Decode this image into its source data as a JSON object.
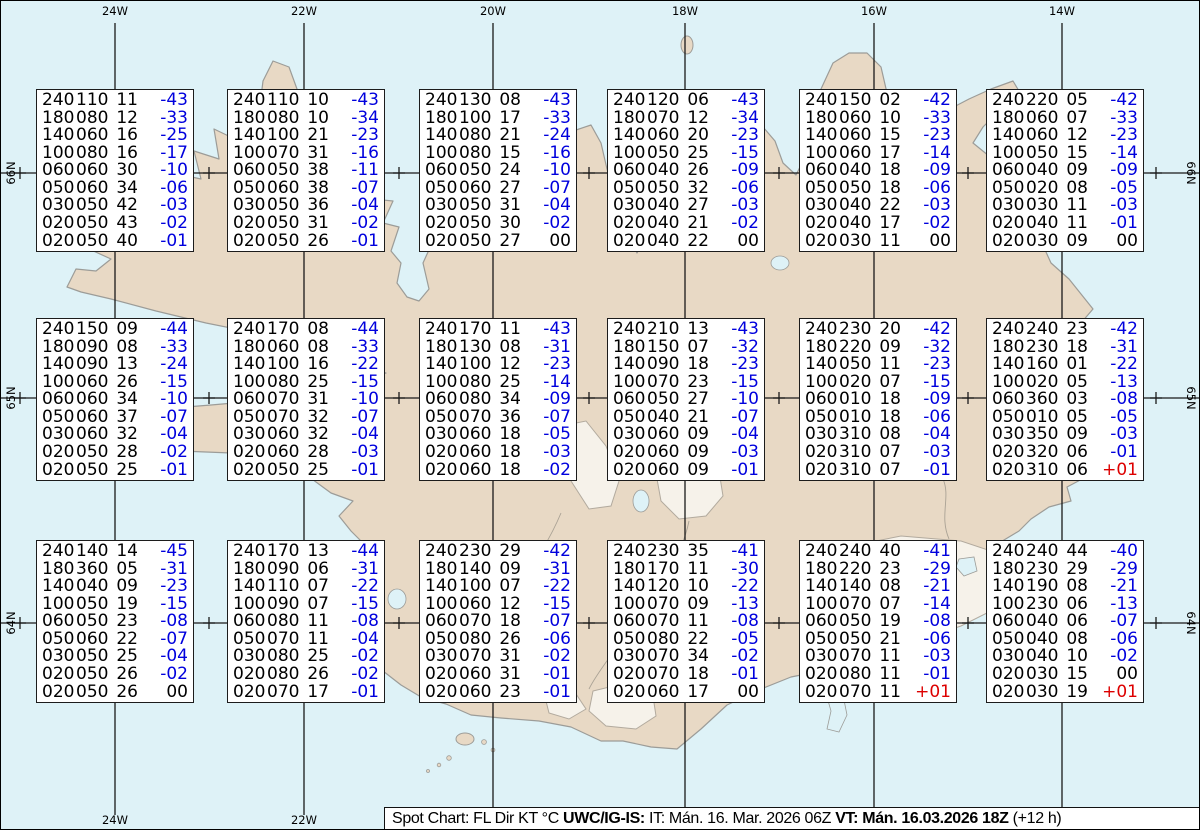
{
  "map": {
    "longitude_labels": [
      "24W",
      "22W",
      "20W",
      "18W",
      "16W",
      "14W"
    ],
    "latitude_labels": [
      "66N",
      "65N",
      "64N"
    ],
    "colors": {
      "water": "#def2f7",
      "land": "#e8d9c5",
      "glacier": "#f6f2ea",
      "coastline": "#9c9c98",
      "grid": "#1a1a1a",
      "temp_negative": "#0000dd",
      "temp_positive": "#dd0000",
      "temp_zero": "#000000"
    }
  },
  "spot_boxes": [
    {
      "lines": [
        [
          "240",
          "110",
          "11",
          "-43"
        ],
        [
          "180",
          "080",
          "12",
          "-33"
        ],
        [
          "140",
          "060",
          "16",
          "-25"
        ],
        [
          "100",
          "080",
          "16",
          "-17"
        ],
        [
          "060",
          "060",
          "30",
          "-10"
        ],
        [
          "050",
          "060",
          "34",
          "-06"
        ],
        [
          "030",
          "050",
          "42",
          "-03"
        ],
        [
          "020",
          "050",
          "43",
          "-02"
        ],
        [
          "020",
          "050",
          "40",
          "-01"
        ]
      ]
    },
    {
      "lines": [
        [
          "240",
          "110",
          "10",
          "-43"
        ],
        [
          "180",
          "080",
          "10",
          "-34"
        ],
        [
          "140",
          "100",
          "21",
          "-23"
        ],
        [
          "100",
          "070",
          "31",
          "-16"
        ],
        [
          "060",
          "050",
          "38",
          "-11"
        ],
        [
          "050",
          "060",
          "38",
          "-07"
        ],
        [
          "030",
          "050",
          "36",
          "-04"
        ],
        [
          "020",
          "050",
          "31",
          "-02"
        ],
        [
          "020",
          "050",
          "26",
          "-01"
        ]
      ]
    },
    {
      "lines": [
        [
          "240",
          "130",
          "08",
          "-43"
        ],
        [
          "180",
          "100",
          "17",
          "-33"
        ],
        [
          "140",
          "080",
          "21",
          "-24"
        ],
        [
          "100",
          "080",
          "15",
          "-16"
        ],
        [
          "060",
          "050",
          "24",
          "-10"
        ],
        [
          "050",
          "060",
          "27",
          "-07"
        ],
        [
          "030",
          "050",
          "31",
          "-04"
        ],
        [
          "020",
          "050",
          "30",
          "-02"
        ],
        [
          "020",
          "050",
          "27",
          "00"
        ]
      ]
    },
    {
      "lines": [
        [
          "240",
          "120",
          "06",
          "-43"
        ],
        [
          "180",
          "070",
          "12",
          "-34"
        ],
        [
          "140",
          "060",
          "20",
          "-23"
        ],
        [
          "100",
          "050",
          "25",
          "-15"
        ],
        [
          "060",
          "040",
          "26",
          "-09"
        ],
        [
          "050",
          "050",
          "32",
          "-06"
        ],
        [
          "030",
          "040",
          "27",
          "-03"
        ],
        [
          "020",
          "040",
          "21",
          "-02"
        ],
        [
          "020",
          "040",
          "22",
          "00"
        ]
      ]
    },
    {
      "lines": [
        [
          "240",
          "150",
          "02",
          "-42"
        ],
        [
          "180",
          "060",
          "10",
          "-33"
        ],
        [
          "140",
          "060",
          "15",
          "-23"
        ],
        [
          "100",
          "060",
          "17",
          "-14"
        ],
        [
          "060",
          "040",
          "18",
          "-09"
        ],
        [
          "050",
          "050",
          "18",
          "-06"
        ],
        [
          "030",
          "040",
          "22",
          "-03"
        ],
        [
          "020",
          "040",
          "17",
          "-02"
        ],
        [
          "020",
          "030",
          "11",
          "00"
        ]
      ]
    },
    {
      "lines": [
        [
          "240",
          "220",
          "05",
          "-42"
        ],
        [
          "180",
          "060",
          "07",
          "-33"
        ],
        [
          "140",
          "060",
          "12",
          "-23"
        ],
        [
          "100",
          "050",
          "15",
          "-14"
        ],
        [
          "060",
          "040",
          "09",
          "-09"
        ],
        [
          "050",
          "020",
          "08",
          "-05"
        ],
        [
          "030",
          "030",
          "11",
          "-03"
        ],
        [
          "020",
          "040",
          "11",
          "-01"
        ],
        [
          "020",
          "030",
          "09",
          "00"
        ]
      ]
    },
    {
      "lines": [
        [
          "240",
          "150",
          "09",
          "-44"
        ],
        [
          "180",
          "090",
          "08",
          "-33"
        ],
        [
          "140",
          "090",
          "13",
          "-24"
        ],
        [
          "100",
          "060",
          "26",
          "-15"
        ],
        [
          "060",
          "060",
          "34",
          "-10"
        ],
        [
          "050",
          "060",
          "37",
          "-07"
        ],
        [
          "030",
          "060",
          "32",
          "-04"
        ],
        [
          "020",
          "050",
          "28",
          "-02"
        ],
        [
          "020",
          "050",
          "25",
          "-01"
        ]
      ]
    },
    {
      "lines": [
        [
          "240",
          "170",
          "08",
          "-44"
        ],
        [
          "180",
          "060",
          "08",
          "-33"
        ],
        [
          "140",
          "100",
          "16",
          "-22"
        ],
        [
          "100",
          "080",
          "25",
          "-15"
        ],
        [
          "060",
          "070",
          "31",
          "-10"
        ],
        [
          "050",
          "070",
          "32",
          "-07"
        ],
        [
          "030",
          "060",
          "32",
          "-04"
        ],
        [
          "020",
          "060",
          "28",
          "-03"
        ],
        [
          "020",
          "050",
          "25",
          "-01"
        ]
      ]
    },
    {
      "lines": [
        [
          "240",
          "170",
          "11",
          "-43"
        ],
        [
          "180",
          "130",
          "08",
          "-31"
        ],
        [
          "140",
          "100",
          "12",
          "-23"
        ],
        [
          "100",
          "080",
          "25",
          "-14"
        ],
        [
          "060",
          "080",
          "34",
          "-09"
        ],
        [
          "050",
          "070",
          "36",
          "-07"
        ],
        [
          "030",
          "060",
          "18",
          "-05"
        ],
        [
          "020",
          "060",
          "18",
          "-03"
        ],
        [
          "020",
          "060",
          "18",
          "-02"
        ]
      ]
    },
    {
      "lines": [
        [
          "240",
          "210",
          "13",
          "-43"
        ],
        [
          "180",
          "150",
          "07",
          "-32"
        ],
        [
          "140",
          "090",
          "18",
          "-23"
        ],
        [
          "100",
          "070",
          "23",
          "-15"
        ],
        [
          "060",
          "050",
          "27",
          "-10"
        ],
        [
          "050",
          "040",
          "21",
          "-07"
        ],
        [
          "030",
          "060",
          "09",
          "-04"
        ],
        [
          "020",
          "060",
          "09",
          "-03"
        ],
        [
          "020",
          "060",
          "09",
          "-01"
        ]
      ]
    },
    {
      "lines": [
        [
          "240",
          "230",
          "20",
          "-42"
        ],
        [
          "180",
          "220",
          "09",
          "-32"
        ],
        [
          "140",
          "050",
          "11",
          "-23"
        ],
        [
          "100",
          "020",
          "07",
          "-15"
        ],
        [
          "060",
          "010",
          "18",
          "-09"
        ],
        [
          "050",
          "010",
          "18",
          "-06"
        ],
        [
          "030",
          "310",
          "08",
          "-04"
        ],
        [
          "020",
          "310",
          "07",
          "-03"
        ],
        [
          "020",
          "310",
          "07",
          "-01"
        ]
      ]
    },
    {
      "lines": [
        [
          "240",
          "240",
          "23",
          "-42"
        ],
        [
          "180",
          "230",
          "18",
          "-31"
        ],
        [
          "140",
          "160",
          "01",
          "-22"
        ],
        [
          "100",
          "020",
          "05",
          "-13"
        ],
        [
          "060",
          "360",
          "03",
          "-08"
        ],
        [
          "050",
          "010",
          "05",
          "-05"
        ],
        [
          "030",
          "350",
          "09",
          "-03"
        ],
        [
          "020",
          "320",
          "06",
          "-01"
        ],
        [
          "020",
          "310",
          "06",
          "+01"
        ]
      ]
    },
    {
      "lines": [
        [
          "240",
          "140",
          "14",
          "-45"
        ],
        [
          "180",
          "360",
          "05",
          "-31"
        ],
        [
          "140",
          "040",
          "09",
          "-23"
        ],
        [
          "100",
          "050",
          "19",
          "-15"
        ],
        [
          "060",
          "050",
          "23",
          "-08"
        ],
        [
          "050",
          "060",
          "22",
          "-07"
        ],
        [
          "030",
          "050",
          "25",
          "-04"
        ],
        [
          "020",
          "050",
          "26",
          "-02"
        ],
        [
          "020",
          "050",
          "26",
          "00"
        ]
      ]
    },
    {
      "lines": [
        [
          "240",
          "170",
          "13",
          "-44"
        ],
        [
          "180",
          "090",
          "06",
          "-31"
        ],
        [
          "140",
          "110",
          "07",
          "-22"
        ],
        [
          "100",
          "090",
          "07",
          "-15"
        ],
        [
          "060",
          "080",
          "11",
          "-08"
        ],
        [
          "050",
          "070",
          "11",
          "-04"
        ],
        [
          "030",
          "080",
          "25",
          "-02"
        ],
        [
          "020",
          "080",
          "26",
          "-02"
        ],
        [
          "020",
          "070",
          "17",
          "-01"
        ]
      ]
    },
    {
      "lines": [
        [
          "240",
          "230",
          "29",
          "-42"
        ],
        [
          "180",
          "140",
          "09",
          "-31"
        ],
        [
          "140",
          "100",
          "07",
          "-22"
        ],
        [
          "100",
          "060",
          "12",
          "-15"
        ],
        [
          "060",
          "070",
          "18",
          "-07"
        ],
        [
          "050",
          "080",
          "26",
          "-06"
        ],
        [
          "030",
          "070",
          "31",
          "-02"
        ],
        [
          "020",
          "060",
          "31",
          "-01"
        ],
        [
          "020",
          "060",
          "23",
          "-01"
        ]
      ]
    },
    {
      "lines": [
        [
          "240",
          "230",
          "35",
          "-41"
        ],
        [
          "180",
          "170",
          "11",
          "-30"
        ],
        [
          "140",
          "120",
          "10",
          "-22"
        ],
        [
          "100",
          "070",
          "09",
          "-13"
        ],
        [
          "060",
          "070",
          "11",
          "-08"
        ],
        [
          "050",
          "080",
          "22",
          "-05"
        ],
        [
          "030",
          "070",
          "34",
          "-02"
        ],
        [
          "020",
          "070",
          "18",
          "-01"
        ],
        [
          "020",
          "060",
          "17",
          "00"
        ]
      ]
    },
    {
      "lines": [
        [
          "240",
          "240",
          "40",
          "-41"
        ],
        [
          "180",
          "220",
          "23",
          "-29"
        ],
        [
          "140",
          "140",
          "08",
          "-21"
        ],
        [
          "100",
          "070",
          "07",
          "-14"
        ],
        [
          "060",
          "050",
          "19",
          "-08"
        ],
        [
          "050",
          "050",
          "21",
          "-06"
        ],
        [
          "030",
          "070",
          "11",
          "-03"
        ],
        [
          "020",
          "080",
          "11",
          "-01"
        ],
        [
          "020",
          "070",
          "11",
          "+01"
        ]
      ]
    },
    {
      "lines": [
        [
          "240",
          "240",
          "44",
          "-40"
        ],
        [
          "180",
          "230",
          "29",
          "-29"
        ],
        [
          "140",
          "190",
          "08",
          "-21"
        ],
        [
          "100",
          "230",
          "06",
          "-13"
        ],
        [
          "060",
          "040",
          "06",
          "-07"
        ],
        [
          "050",
          "040",
          "08",
          "-06"
        ],
        [
          "030",
          "040",
          "10",
          "-02"
        ],
        [
          "020",
          "030",
          "15",
          "00"
        ],
        [
          "020",
          "030",
          "19",
          "+01"
        ]
      ]
    }
  ],
  "footer_segments": [
    {
      "text": "Spot Chart: FL Dir KT °C ",
      "bold": false
    },
    {
      "text": "UWC/IG-IS:",
      "bold": true
    },
    {
      "text": " IT: Mán. 16. Mar. 2026 06Z ",
      "bold": false
    },
    {
      "text": "VT: Mán. 16.03.2026 18Z",
      "bold": true
    },
    {
      "text": " (+12 h)",
      "bold": false
    }
  ]
}
